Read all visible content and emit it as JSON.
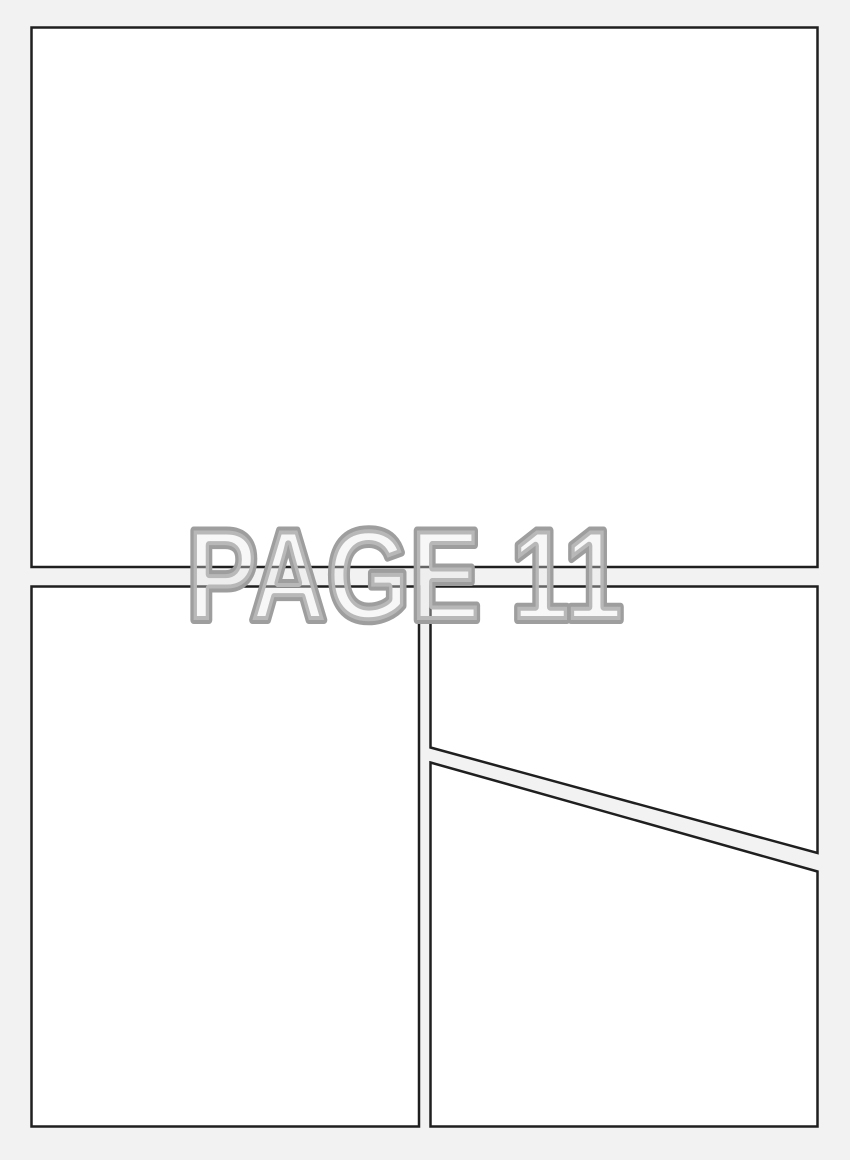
{
  "page": {
    "label": "PAGE 11",
    "background_color": "#f2f2f2",
    "panel_fill": "#ffffff",
    "panel_border_color": "#1f1f1f",
    "label_fill_color": "#e8e8e8",
    "label_outline_color": "#9e9e9e",
    "panels": [
      {
        "id": "panel-1",
        "position": "top",
        "shape": "rectangle"
      },
      {
        "id": "panel-2",
        "position": "bottom-left",
        "shape": "rectangle"
      },
      {
        "id": "panel-3",
        "position": "middle-right",
        "shape": "quad-diagonal-bottom"
      },
      {
        "id": "panel-4",
        "position": "bottom-right",
        "shape": "quad-diagonal-top"
      }
    ]
  }
}
